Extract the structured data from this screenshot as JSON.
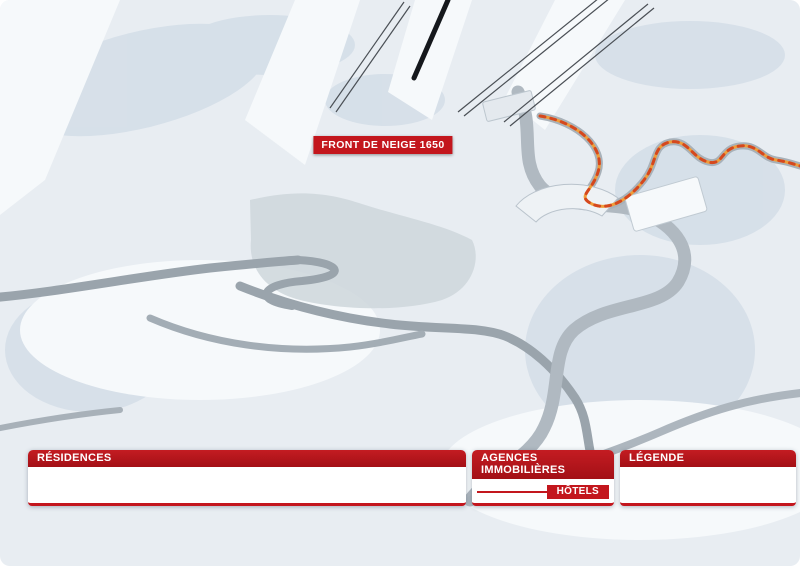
{
  "map": {
    "banner": "FRONT DE NEIGE 1650",
    "arret_label": "ARRÊT",
    "labels": [
      {
        "t": "ESPACE LUGE",
        "x": 104,
        "y": 15,
        "r": -18,
        "c": "sm"
      },
      {
        "t": "ESPACE\nLUGE\n+ DE 7 ANS",
        "x": 316,
        "y": 52,
        "r": -62,
        "c": "sm"
      },
      {
        "t": "TÉLÉSKI DU PIC VERT",
        "x": 357,
        "y": 68,
        "r": -73,
        "c": "lift"
      },
      {
        "t": "L'ORRIAN EXPRESS\nLUGE",
        "x": 392,
        "y": 86,
        "c": "sm"
      },
      {
        "t": "TÉLÉSIÈGE DE BOIS LONG",
        "x": 512,
        "y": 60,
        "r": -52,
        "c": "lift"
      },
      {
        "t": "TÉLÉSIÈGE DE PRÉLONGIS",
        "x": 562,
        "y": 66,
        "r": -52,
        "c": "lift"
      },
      {
        "t": "SEMLORE\nREMONTÉES MÉCANIQUES\nPOSTE DE SECOURS",
        "x": 534,
        "y": 126,
        "c": "sm left"
      },
      {
        "t": "CLUB\nPIOU PIOU ESF",
        "x": 196,
        "y": 131
      },
      {
        "t": "JARDIN DES NEIGES",
        "x": 243,
        "y": 142,
        "r": -10
      },
      {
        "t": "HALTE-GARDERIE\nLES P'TICHOUNETS",
        "x": 146,
        "y": 186
      },
      {
        "t": "ESPACE\nLUGE",
        "x": 136,
        "y": 214,
        "r": -15,
        "c": "sm"
      },
      {
        "t": "MOINS\nDE 6 ANS",
        "x": 158,
        "y": 218,
        "r": -10,
        "c": "sm"
      },
      {
        "t": "VILLAGES",
        "x": 199,
        "y": 209
      },
      {
        "t": "CHAMP LACAS",
        "x": 253,
        "y": 217
      },
      {
        "t": "MÉAN ET EMBRUN",
        "x": 152,
        "y": 258
      },
      {
        "t": "PONT SKIEURS",
        "x": 163,
        "y": 271,
        "r": -10,
        "c": "sm"
      },
      {
        "t": "ALLÉE DES CHAMOIS",
        "x": 100,
        "y": 283,
        "r": -7
      },
      {
        "t": "OFFICE DE TOURISME",
        "x": 250,
        "y": 259,
        "r": -18,
        "c": "sm"
      },
      {
        "t": "BIBLIOTHÈQUE",
        "x": 227,
        "y": 267,
        "r": -12,
        "c": "sm"
      },
      {
        "t": "POSTE",
        "x": 266,
        "y": 272,
        "r": -15,
        "c": "sm"
      },
      {
        "t": "DÉPOSE CARS",
        "x": 242,
        "y": 287,
        "r": -18,
        "c": "sm"
      },
      {
        "t": "POLICE\nMUNICIPALE",
        "x": 277,
        "y": 293,
        "r": -8,
        "c": "sm"
      },
      {
        "t": "Place d'accueil",
        "x": 291,
        "y": 255,
        "c": "it"
      },
      {
        "t": "Place du festival",
        "x": 318,
        "y": 184,
        "c": "it"
      },
      {
        "t": "LA BULLE\nÉCOLE DU\nSKI FRANÇAIS",
        "x": 348,
        "y": 197,
        "c": "sm"
      },
      {
        "t": "GALERIE MARCHANDE",
        "x": 311,
        "y": 214,
        "r": -6
      },
      {
        "t": "CAISSES\nCENTRALES",
        "x": 399,
        "y": 181,
        "c": "sm"
      },
      {
        "t": "CABINET\nMÉDICAL",
        "x": 396,
        "y": 221,
        "c": "sm"
      },
      {
        "t": "CINÉMA",
        "x": 398,
        "y": 239
      },
      {
        "t": "LAVERIE",
        "x": 465,
        "y": 151,
        "r": -8,
        "c": "sm"
      },
      {
        "t": "ÉCOLE DE SKI\nOZONE",
        "x": 428,
        "y": 204,
        "c": "sm"
      },
      {
        "t": "SALLE DE\nSÉMINAIRES",
        "x": 443,
        "y": 292,
        "c": "sm"
      },
      {
        "t": "GENDARMERIE",
        "x": 449,
        "y": 305,
        "c": "sm"
      },
      {
        "t": "PATINOIRE",
        "x": 589,
        "y": 220
      },
      {
        "t": "PATINOIRE",
        "x": 556,
        "y": 258
      },
      {
        "t": "VERS EMBRUN",
        "x": 551,
        "y": 286,
        "r": 28,
        "c": "sm"
      },
      {
        "t": "ESPACE RENCONTRE\nET CULTURE",
        "x": 671,
        "y": 231
      },
      {
        "t": "CHEMIN PIÉTONNIER\nVERS LES ORRES 1800\nBOIS MÉAN",
        "x": 753,
        "y": 183,
        "r": -8,
        "c": "sm"
      },
      {
        "t": "CHEMIN DU RIOU SEC",
        "x": 716,
        "y": 381
      },
      {
        "t": "ROUTE DE PRAMOUTON",
        "x": 322,
        "y": 315,
        "r": -13
      },
      {
        "t": "CHEMIN DU MOUFLON",
        "x": 360,
        "y": 346,
        "r": -11
      },
      {
        "t": "CHEMIN DU GRAND CORBEAU",
        "x": 482,
        "y": 341,
        "r": -48
      },
      {
        "t": "VERS MÉAN",
        "x": 121,
        "y": 252,
        "c": "sm"
      }
    ],
    "markers": {
      "residences": [
        [
          4,
          501,
          181
        ],
        [
          6,
          424,
          332
        ],
        [
          7,
          283,
          186
        ],
        [
          9,
          377,
          266
        ],
        [
          10,
          327,
          207
        ],
        [
          11,
          301,
          207
        ],
        [
          15,
          779,
          379
        ],
        [
          16,
          27,
          101
        ],
        [
          19,
          427,
          277
        ],
        [
          21,
          23,
          284
        ],
        [
          23,
          88,
          399
        ],
        [
          25,
          210,
          383
        ],
        [
          28,
          477,
          210
        ],
        [
          29,
          455,
          178
        ],
        [
          30,
          491,
          196
        ],
        [
          31,
          452,
          241
        ],
        [
          32,
          434,
          193
        ],
        [
          33,
          202,
          298
        ],
        [
          37,
          639,
          98
        ],
        [
          40,
          56,
          166
        ],
        [
          41,
          111,
          233
        ]
      ],
      "hotels": [
        [
          45,
          279,
          166
        ],
        [
          46,
          329,
          281
        ],
        [
          47,
          333,
          230
        ],
        [
          49,
          778,
          244
        ]
      ],
      "agencies": [
        [
          60,
          373,
          254
        ],
        [
          61,
          327,
          247
        ],
        [
          62,
          294,
          172
        ]
      ]
    },
    "icons": {
      "bus": [
        [
          216,
          208
        ],
        [
          230,
          216
        ],
        [
          184,
          258
        ],
        [
          531,
          257
        ],
        [
          678,
          380
        ]
      ],
      "recycle-green": [
        [
          193,
          233
        ],
        [
          49,
          279
        ],
        [
          357,
          325
        ],
        [
          719,
          156
        ],
        [
          107,
          418
        ]
      ],
      "recycle-orange": [
        [
          253,
          237
        ]
      ],
      "parking": [
        [
          266,
          238
        ]
      ],
      "euro": [
        [
          276,
          224
        ]
      ],
      "wc": [
        [
          303,
          237
        ],
        [
          355,
          268
        ]
      ],
      "elevator": [
        [
          316,
          238
        ],
        [
          409,
          312
        ]
      ]
    }
  },
  "panels": {
    "residences": {
      "title": "RÉSIDENCES",
      "items": [
        [
          4,
          "LE BALCON DES ORRES"
        ],
        [
          6,
          "LE BELVÉDÈRE"
        ],
        [
          7,
          "LE BOUSSOLENC"
        ],
        [
          9,
          "LE CAIRN"
        ],
        [
          10,
          "LES CARLINES"
        ],
        [
          11,
          "LES CEMBROS"
        ],
        [
          15,
          "LES ÉCRINS"
        ],
        [
          16,
          "L'ÉPERVIÈRE"
        ],
        [
          19,
          "LES GRADINS"
        ],
        [
          21,
          "L'HORIZON"
        ],
        [
          23,
          "LA MAZELIÈRE"
        ],
        [
          25,
          "LES MÉLÈZES"
        ],
        [
          28,
          "LES ORRIANES DES BLÉS"
        ],
        [
          29,
          "LES ORRIANES DES CIMES"
        ],
        [
          30,
          "LES ORRIANES DES FORÊTS"
        ],
        [
          31,
          "LES ORRIANES DES NEIGES"
        ],
        [
          32,
          "LES ORRIANES DES SOURCES"
        ],
        [
          33,
          "L'OUSTAL"
        ],
        [
          37,
          "LE POUZENC"
        ],
        [
          40,
          "LE SILHOURAÏS"
        ],
        [
          41,
          "LE SUNNY SNOW"
        ]
      ]
    },
    "agencies": {
      "title": "AGENCES IMMOBILIÈRES",
      "items": [
        [
          60,
          "CJM TRANSIMO"
        ],
        [
          61,
          "LOGEVAC IMMOBILIER"
        ],
        [
          62,
          "NEIGE ET SOLEIL"
        ]
      ]
    },
    "hotels": {
      "title": "HÔTELS",
      "items": [
        [
          45,
          "L'ANCOLIE **"
        ],
        [
          46,
          "LES ECRINS **"
        ],
        [
          47,
          "L'ESCALE BLANCHE ***"
        ],
        [
          49,
          "LES TRAPPEURS **"
        ]
      ]
    },
    "legend": {
      "title": "LÉGENDE",
      "items": [
        [
          "bus",
          "ARRET DE NAVETTE"
        ],
        [
          "recycle-green",
          "TRI SELECTIF"
        ],
        [
          "recycle-orange",
          "TRI SELECTIF + VERRE"
        ],
        [
          "wc",
          "TOILETTE"
        ],
        [
          "euro",
          "DISTRIBUTEUR DE BILLETS"
        ],
        [
          "elevator",
          "ASCENSEUR"
        ],
        [
          "parking",
          "PARKING PAYANT ET LIMITÉ"
        ]
      ]
    }
  },
  "colors": {
    "accent_red": "#c3161d",
    "agency_teal": "#1d9fb2",
    "hotel_green": "#2d9e4f",
    "parking_blue": "#0e57a8",
    "trail_orange": "#f09d3a"
  }
}
